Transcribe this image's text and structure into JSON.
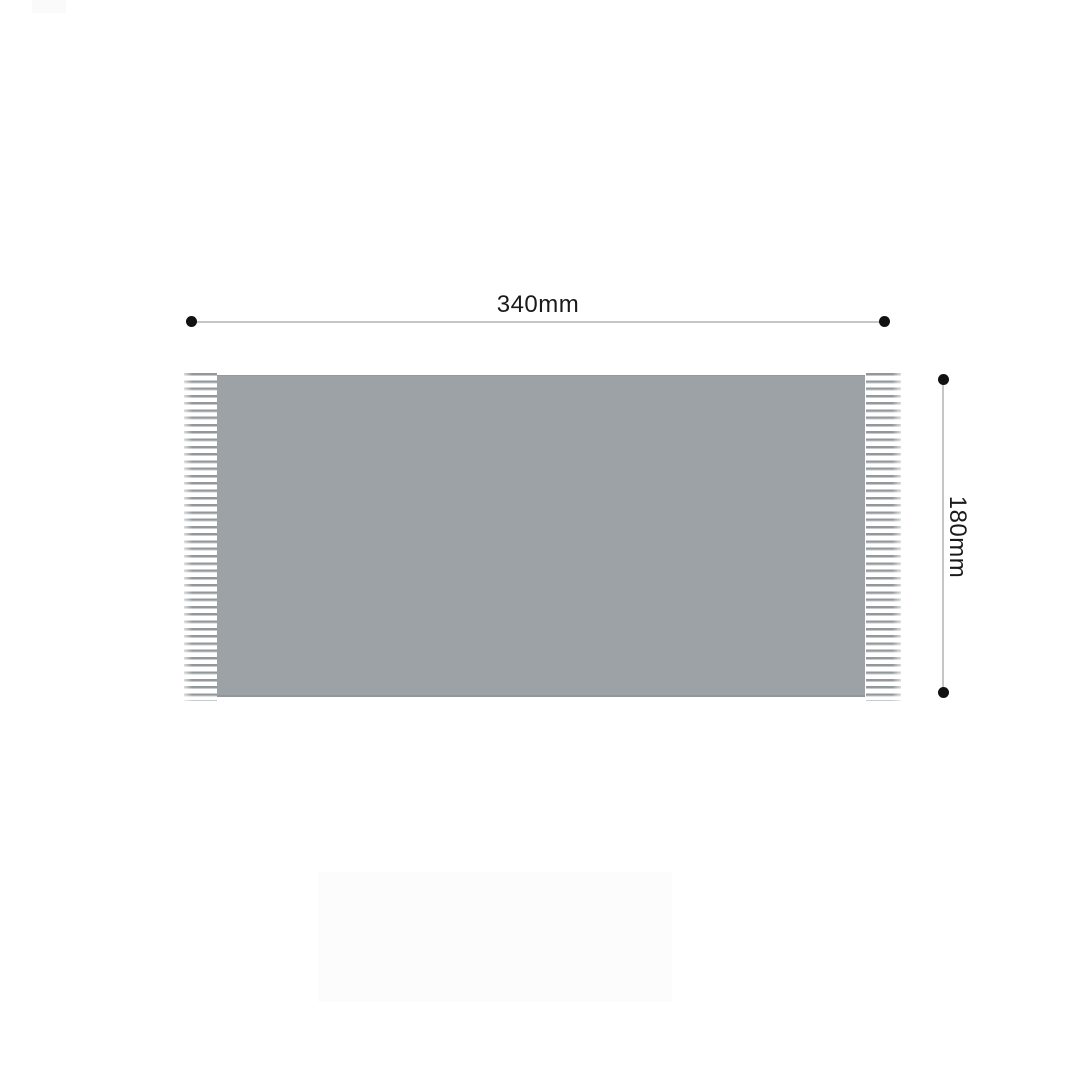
{
  "diagram": {
    "type": "product-dimension-diagram",
    "width_dimension": {
      "label": "340mm",
      "orientation": "horizontal"
    },
    "height_dimension": {
      "label": "180mm",
      "orientation": "vertical"
    },
    "colors": {
      "background": "#ffffff",
      "fabric": "#9da2a6",
      "fringe_strand": "#93989b",
      "dimension_line": "#c6c6c6",
      "endpoint_dot": "#111111",
      "label_text": "#1a1a1a",
      "faint_watermark": "#fcfcfc"
    }
  }
}
